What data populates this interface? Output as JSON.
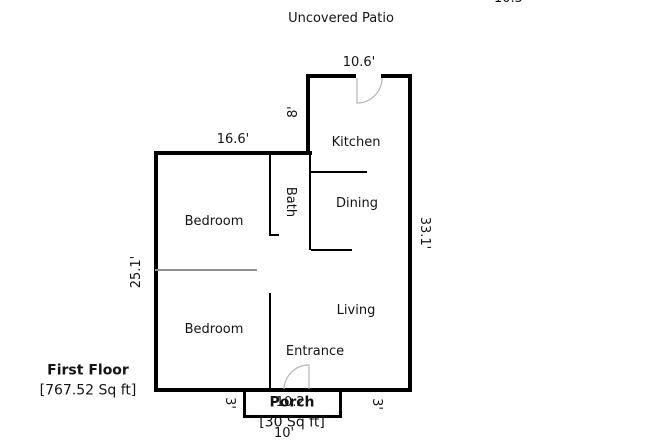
{
  "canvas": {
    "width": 650,
    "height": 444,
    "background": "#ffffff",
    "wall_color": "#000000",
    "divider_color": "#8f8f8f",
    "door_arc_color": "#b5b5b5",
    "text_color": "#141414"
  },
  "header": {
    "patio_label": "Uncovered Patio",
    "clipped_dimension": "10.5'"
  },
  "rooms": {
    "kitchen": "Kitchen",
    "dining": "Dining",
    "bath": "Bath",
    "bedroom1": "Bedroom",
    "bedroom2": "Bedroom",
    "living": "Living",
    "entrance": "Entrance",
    "porch": "Porch"
  },
  "dimensions": {
    "kitchen_width": "10.6'",
    "kitchen_left_height": "8'",
    "top_width": "16.6'",
    "right_height": "33.1'",
    "left_height": "25.1'",
    "porch_side_left": "3'",
    "porch_side_right": "3'",
    "entrance_width": "10.2'",
    "porch_width": "10'"
  },
  "floor_info": {
    "name": "First Floor",
    "area": "[767.52 Sq ft]",
    "porch_area": "[30 Sq ft]"
  }
}
